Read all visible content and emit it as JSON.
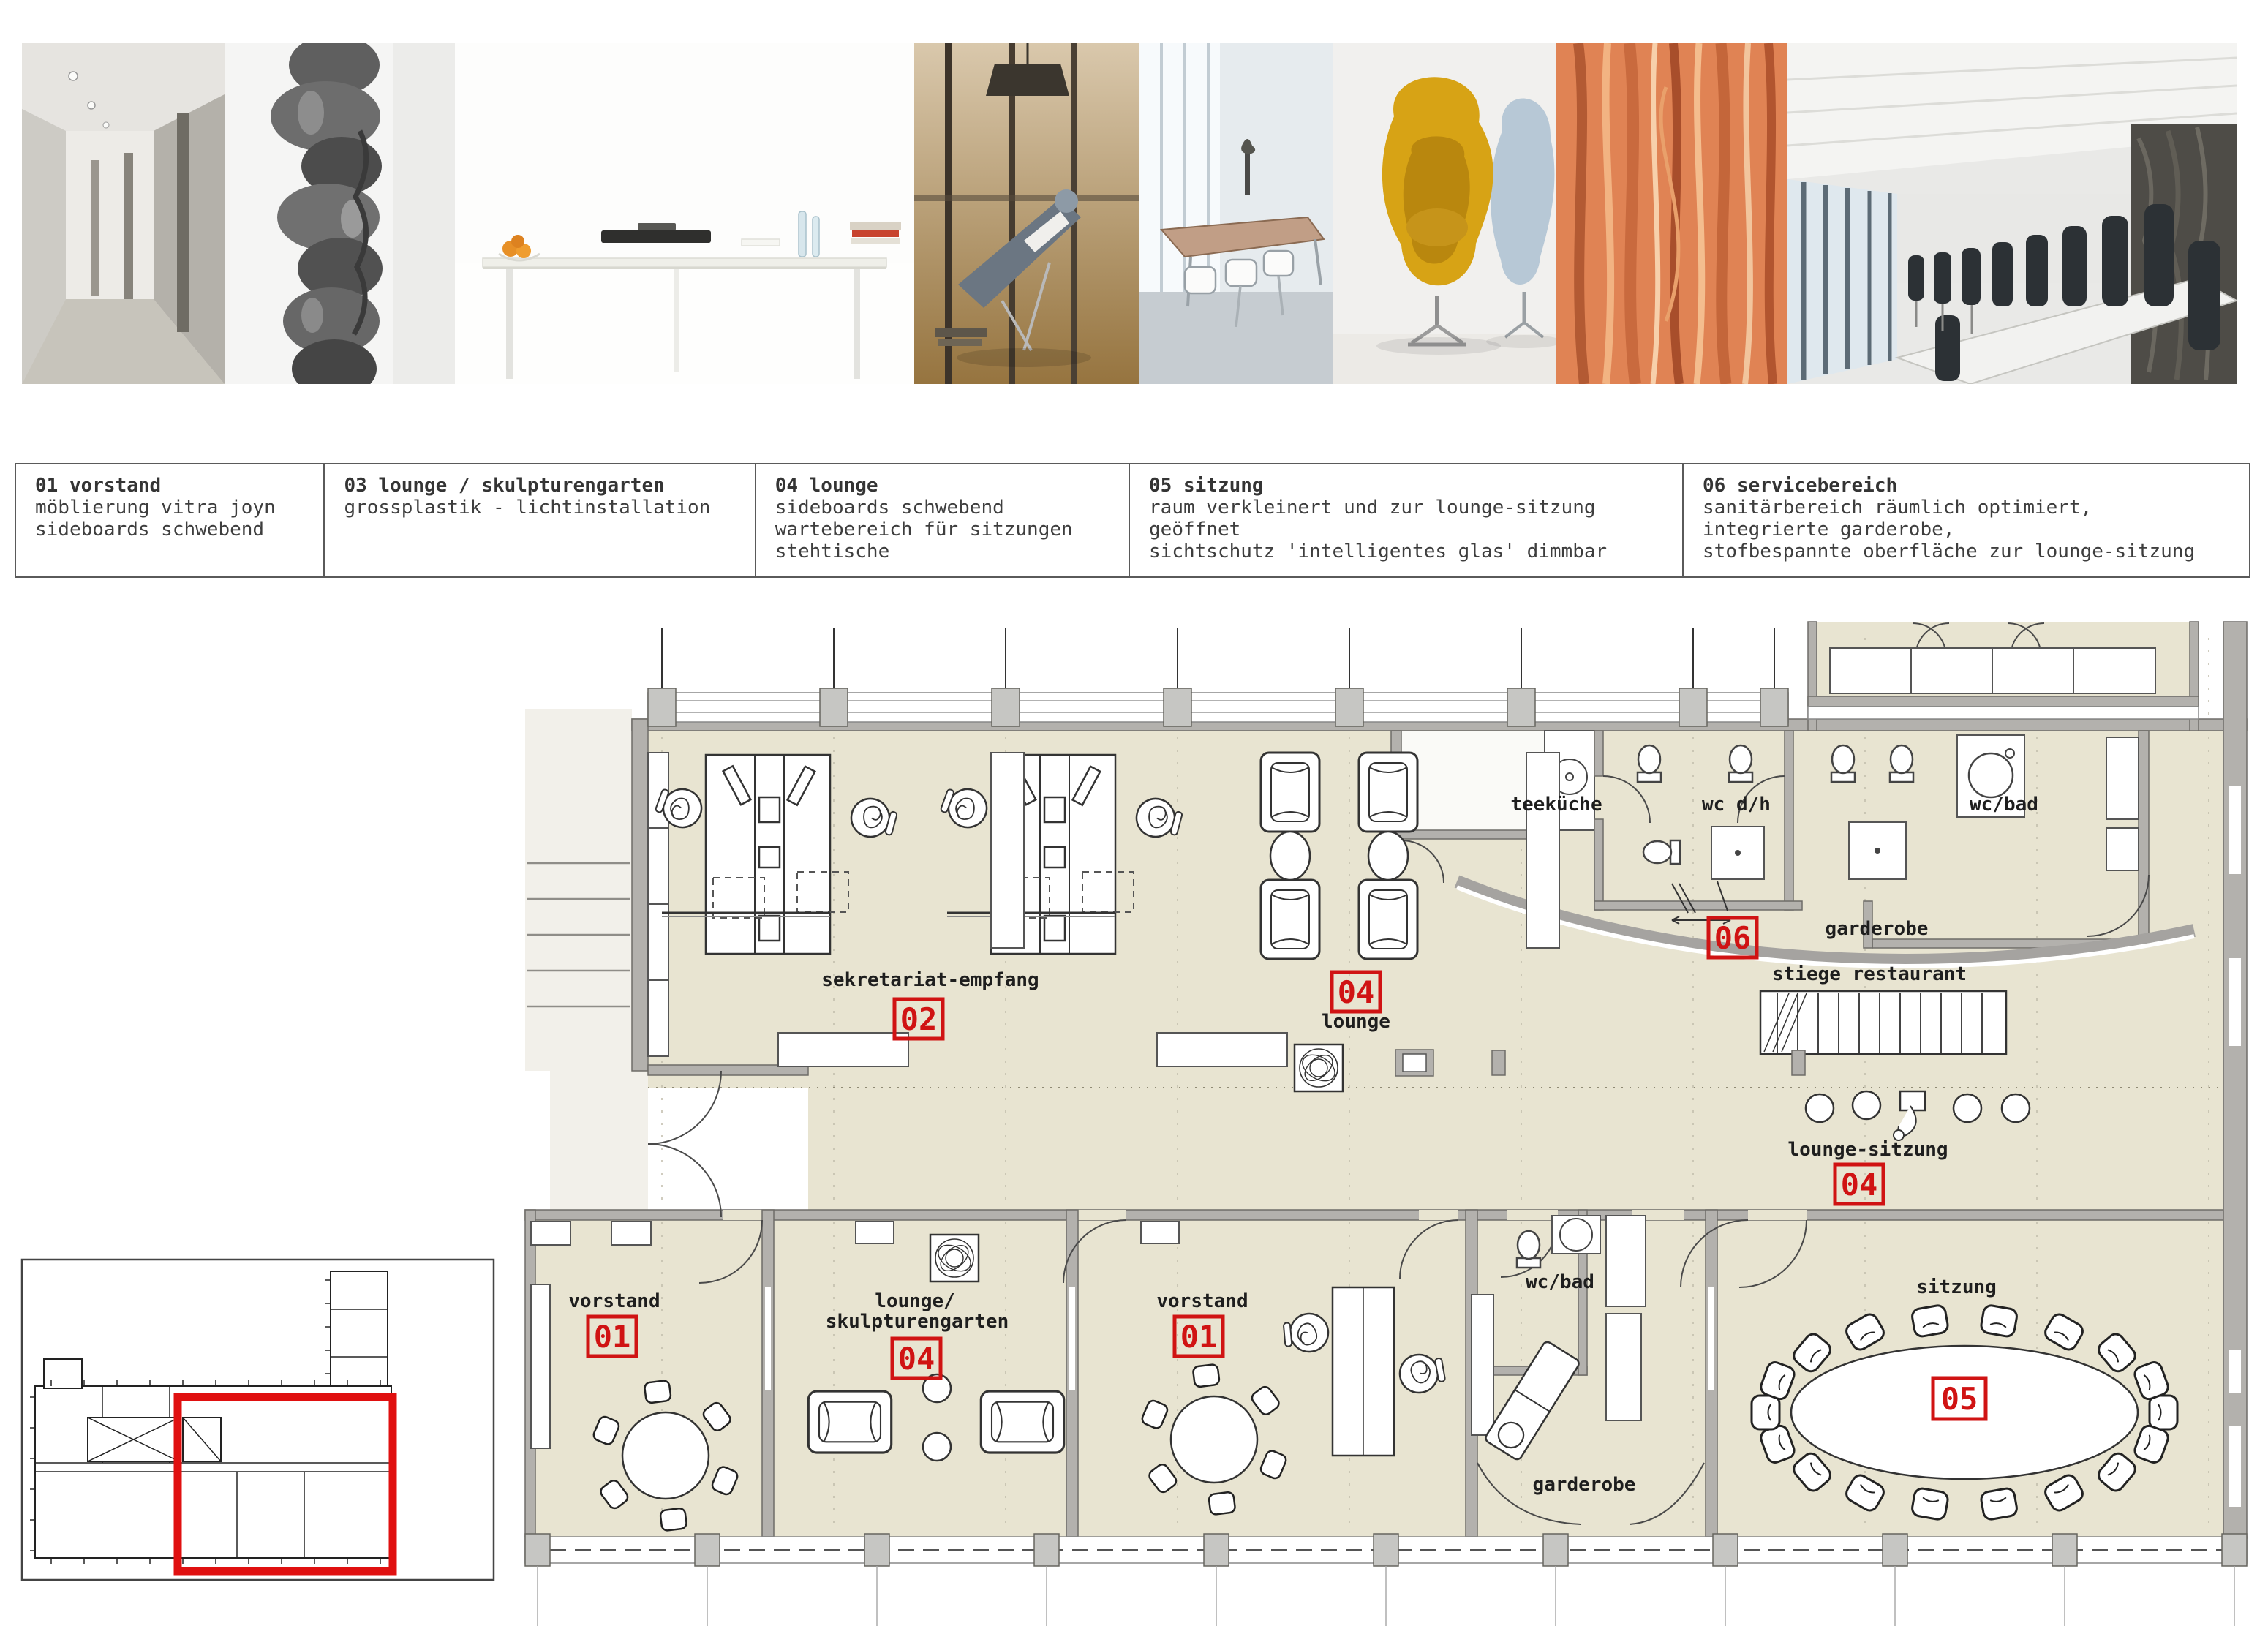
{
  "colors": {
    "floor": "#e8e4d1",
    "wall": "#b3b1ad",
    "marker_red": "#d01313",
    "highlight_red": "#e01010"
  },
  "photos": {
    "names": [
      "corridor-interior",
      "stone-face-sculpture",
      "white-conference-table",
      "man-reclining-window",
      "meeting-room-tables",
      "egg-chairs-yellow-blue",
      "orange-wood-texture",
      "conference-room-black-chairs"
    ]
  },
  "legend": {
    "items": [
      {
        "title": "01 vorstand",
        "line1": "möblierung vitra joyn",
        "line2": "sideboards schwebend"
      },
      {
        "title": "03 lounge / skulpturengarten",
        "line1": "grossplastik - lichtinstallation"
      },
      {
        "title": "04 lounge",
        "line1": "sideboards schwebend",
        "line2": "wartebereich für sitzungen",
        "line3": "stehtische"
      },
      {
        "title": "05 sitzung",
        "line1": "raum verkleinert und zur lounge-sitzung",
        "line2": "geöffnet",
        "line3": "sichtschutz 'intelligentes glas' dimmbar"
      },
      {
        "title": "06 servicebereich",
        "line1": "sanitärbereich räumlich optimiert,",
        "line2": "integrierte garderobe,",
        "line3": "stofbespannte oberfläche zur lounge-sitzung"
      }
    ]
  },
  "plan": {
    "labels": {
      "sekretariat": "sekretariat-empfang",
      "lounge_upper": "lounge",
      "teekueche": "teeküche",
      "wc_dh": "wc d/h",
      "wc_bad_top": "wc/bad",
      "garderobe_top": "garderobe",
      "stiege": "stiege restaurant",
      "lounge_sitzung": "lounge-sitzung",
      "vorstand_left": "vorstand",
      "lounge_sk_1": "lounge/",
      "lounge_sk_2": "skulpturengarten",
      "vorstand_right": "vorstand",
      "wc_bad_bottom": "wc/bad",
      "garderobe_bottom": "garderobe",
      "sitzung": "sitzung"
    },
    "markers": {
      "vorstand_left": "01",
      "sekretariat": "02",
      "lounge_upper": "04",
      "skulpturengarten": "04",
      "vorstand_right": "01",
      "lounge_sitzung": "04",
      "sitzung": "05",
      "service": "06"
    }
  }
}
